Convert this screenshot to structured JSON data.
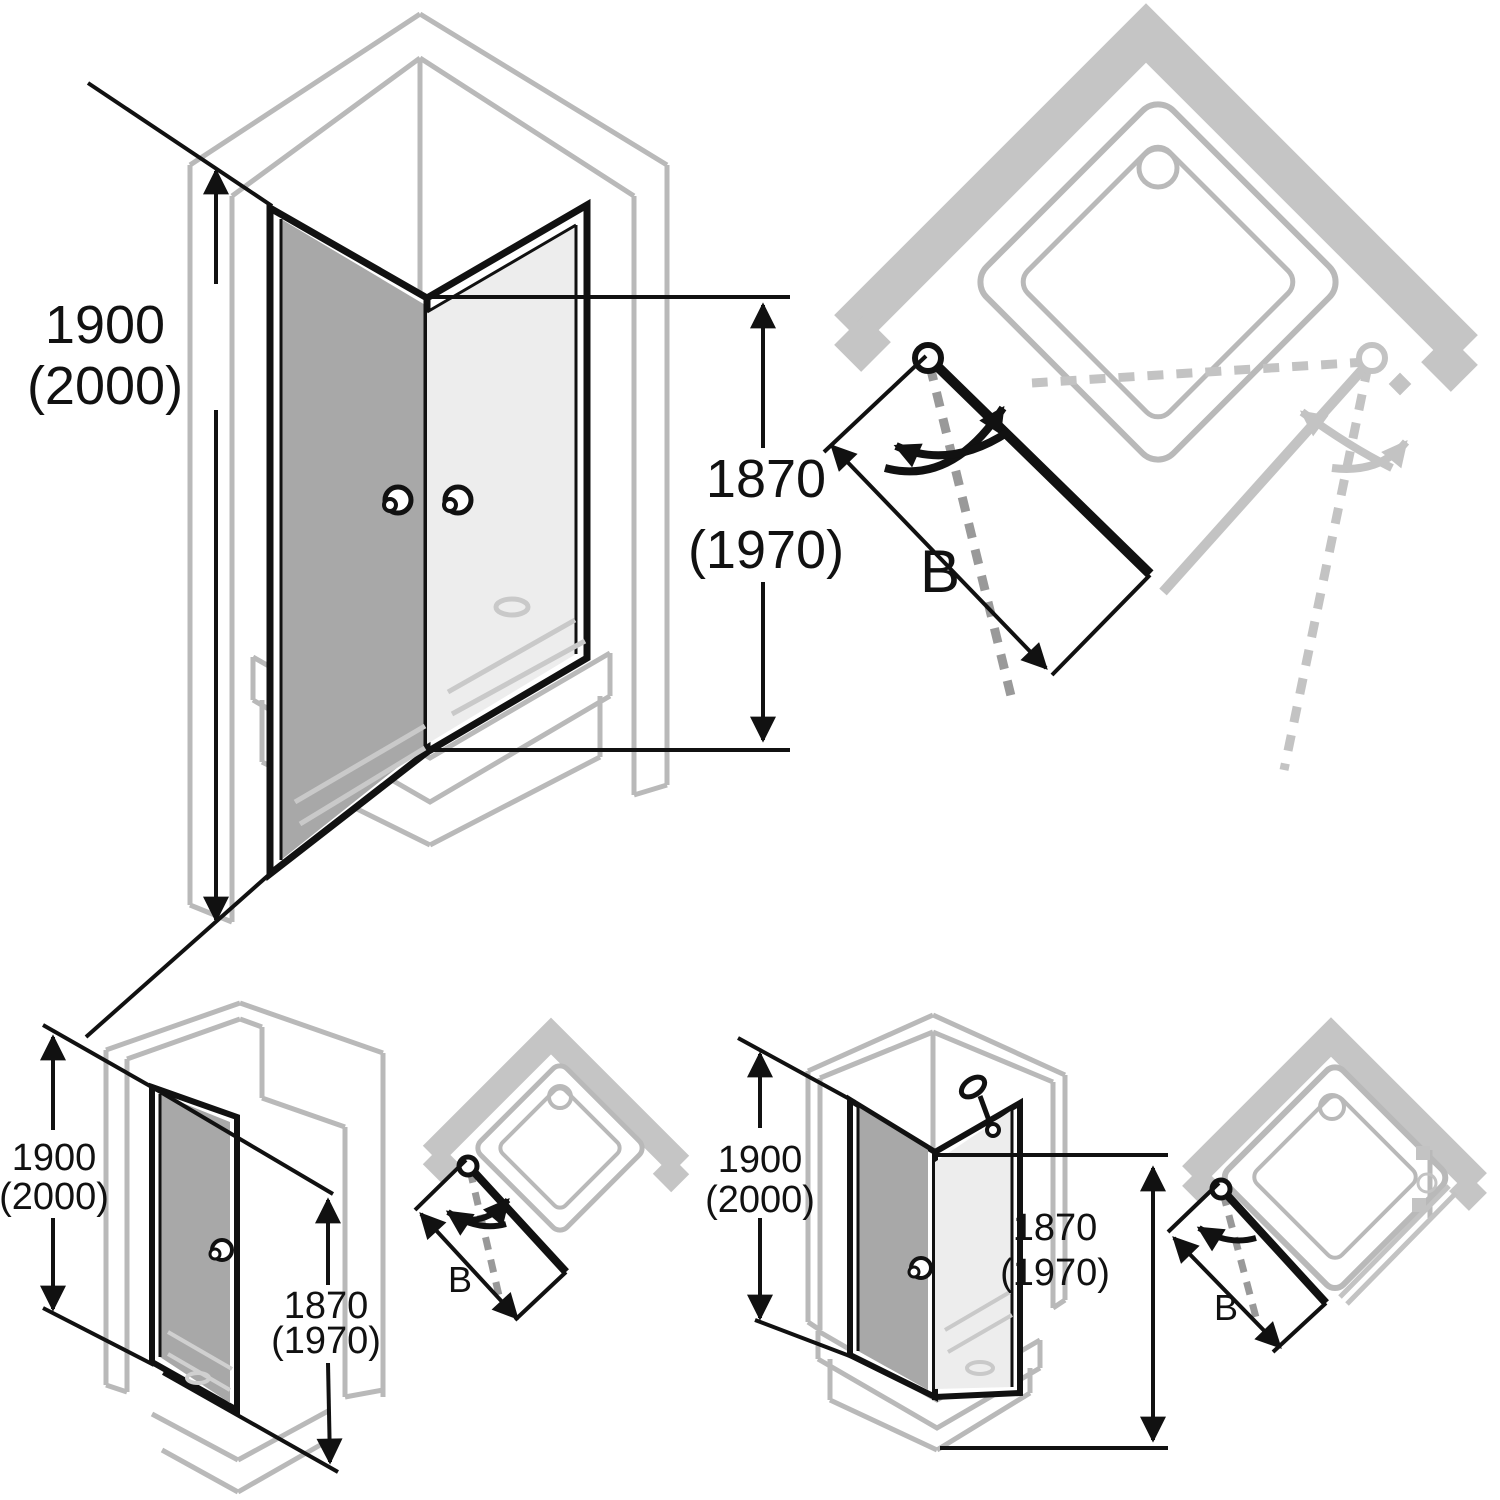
{
  "colors": {
    "line_black": "#111111",
    "line_gray": "#b9b9b9",
    "wall_band_gray": "#c5c5c5",
    "glass_dark": "#a8a8a8",
    "glass_light": "#ededed",
    "dashed_dark": "#999999",
    "light_element_gray": "#c3c3c3",
    "through_glass_gray": "#c9c9c9"
  },
  "figures": {
    "corner_entry_3d": {
      "height": {
        "value": "1900",
        "alt": "(2000)"
      },
      "glass_height": {
        "value": "1870",
        "alt": "(1970)"
      }
    },
    "corner_entry_plan": {
      "width_label": "B"
    },
    "niche_door_3d": {
      "height": {
        "value": "1900",
        "alt": "(2000)"
      },
      "glass_height": {
        "value": "1870",
        "alt": "(1970)"
      }
    },
    "niche_door_plan": {
      "width_label": "B"
    },
    "corner_door_3d": {
      "height": {
        "value": "1900",
        "alt": "(2000)"
      },
      "glass_height": {
        "value": "1870",
        "alt": "(1970)"
      }
    },
    "corner_door_plan": {
      "width_label": "B"
    }
  }
}
